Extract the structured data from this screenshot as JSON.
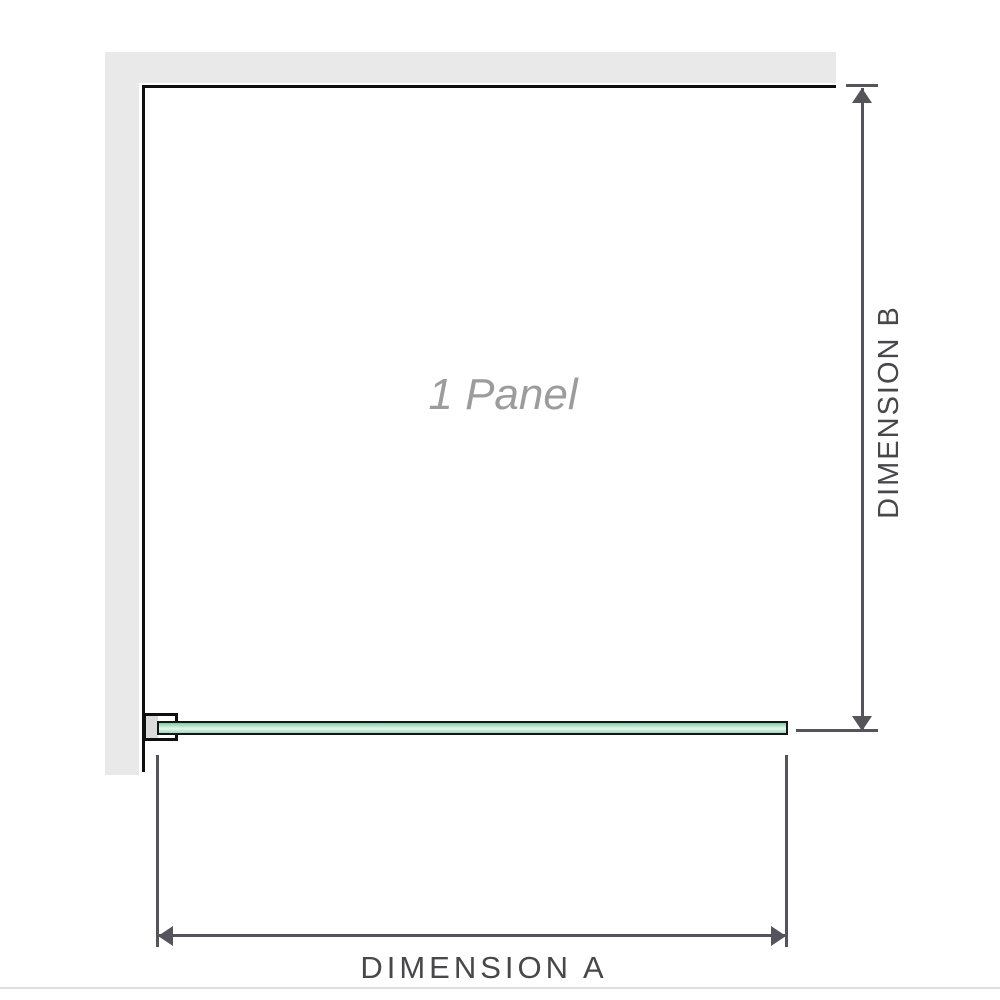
{
  "diagram": {
    "panel_watermark": "1 Panel",
    "dimension_a_label": "DIMENSION A",
    "dimension_b_label": "DIMENSION B"
  },
  "colors": {
    "wall_fill": "#e9e9e9",
    "wall_face_outline": "#0f0f0f",
    "glass_green_dark": "#84c8a4",
    "glass_green_light": "#e4f6ec",
    "dimension_line": "#54545a",
    "dimension_text": "#48484c",
    "watermark_text": "#9c9c9c",
    "separator": "#dfdfdf"
  }
}
